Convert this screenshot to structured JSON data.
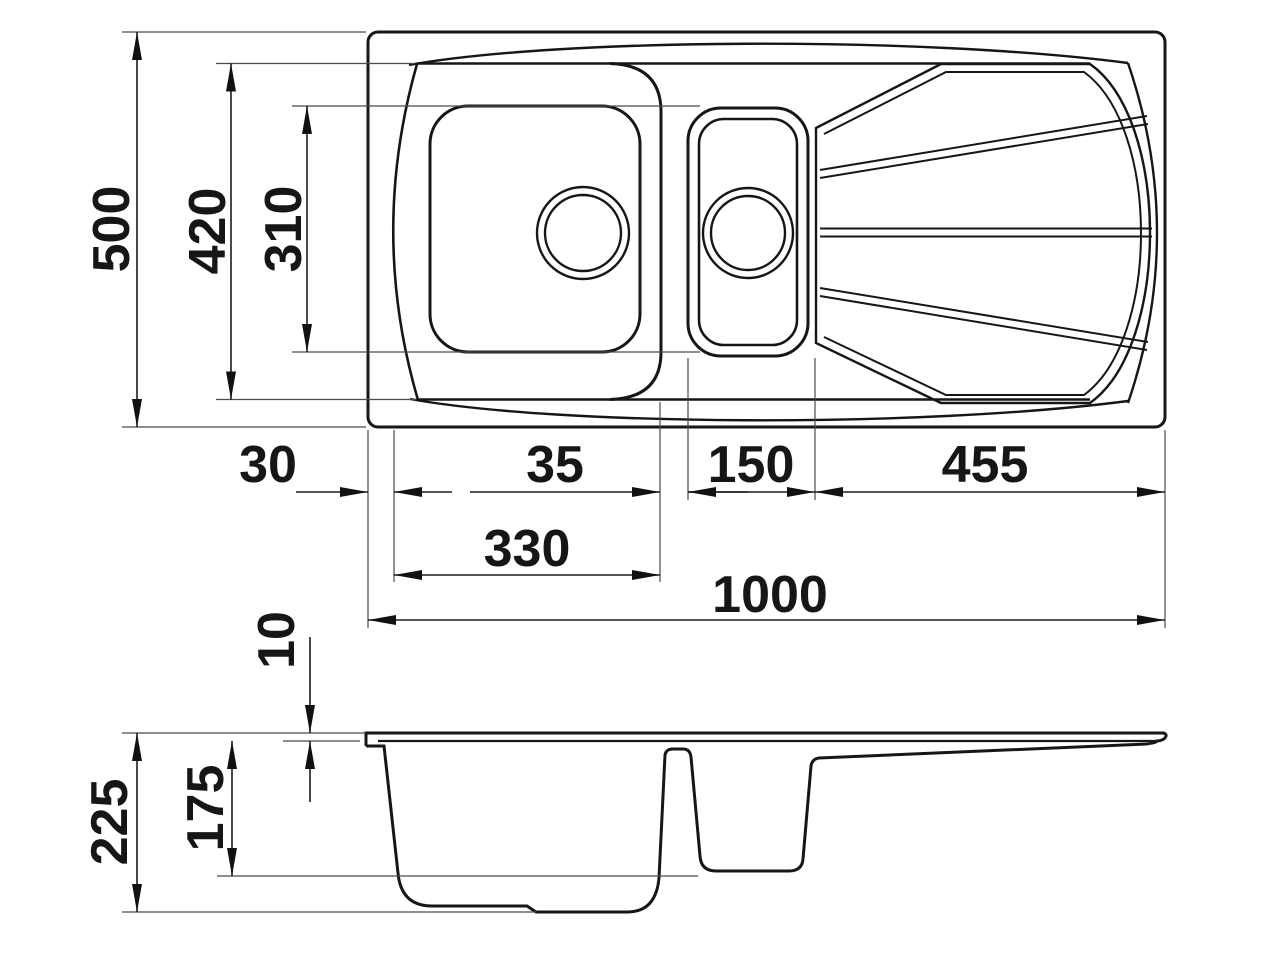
{
  "page": {
    "background": "#ffffff",
    "ink": "#161616",
    "thin_line": "#4a4a4a"
  },
  "drawing": {
    "kind": "technical-dimension-drawing",
    "subject": "kitchen sink with one and a half bowls and drainer",
    "views": [
      "plan-top-view",
      "front-section-view"
    ],
    "units_shown": "none (numbers only)"
  },
  "dims": {
    "d500": "500",
    "d420": "420",
    "d310": "310",
    "d30": "30",
    "d35": "35",
    "d150": "150",
    "d455": "455",
    "d330": "330",
    "d1000": "1000",
    "d10": "10",
    "d175": "175",
    "d225": "225"
  }
}
